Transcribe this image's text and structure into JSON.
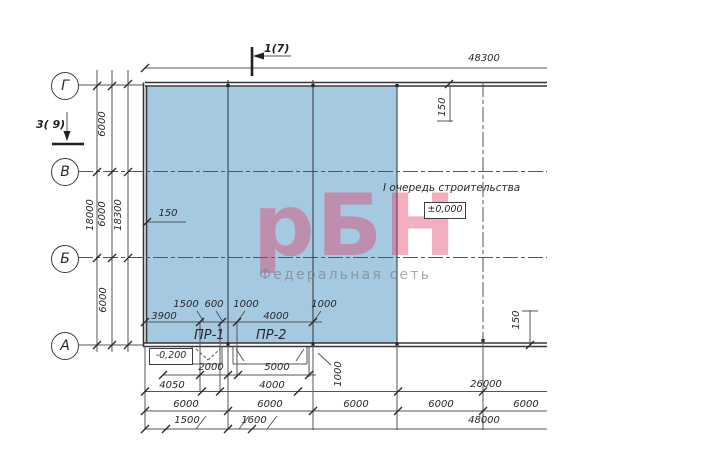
{
  "colors": {
    "phase_fill": "#a6c9e2",
    "watermark_pink": "rgba(224,56,98,0.40)",
    "tagline_gray": "rgba(122,128,136,0.68)",
    "line_dark": "#3c3e41"
  },
  "axes": {
    "markers": [
      "Г",
      "В",
      "Б",
      "А"
    ]
  },
  "sections": {
    "top": "1(7)",
    "left": "3( 9)"
  },
  "notes": {
    "phase": "I очередь строительства"
  },
  "levels": {
    "zero": "±0,000",
    "minus": "-0,200"
  },
  "docks": {
    "pr1": "ПР-1",
    "pr2": "ПР-2"
  },
  "watermark": {
    "logo": "рБН",
    "tagline": "Федеральная сеть"
  },
  "dims": {
    "top_total": "48300",
    "left_total": "18000",
    "left_outer": "18300",
    "left_bays": [
      "6000",
      "6000",
      "6000"
    ],
    "offset_left": "150",
    "offset_top_right": "150",
    "offset_bottom_right": "150",
    "openings_upper": [
      "1500",
      "600",
      "1000",
      "1000"
    ],
    "openings_lower": [
      "3900",
      "4000"
    ],
    "dock_upper": [
      "2000",
      "5000"
    ],
    "dock_offset": "1000",
    "row_4050": [
      "4050",
      "4000",
      "26000"
    ],
    "row_6000": [
      "6000",
      "6000",
      "6000",
      "6000",
      "6000"
    ],
    "row_bottom": [
      "1500",
      "1600",
      "48000"
    ]
  }
}
